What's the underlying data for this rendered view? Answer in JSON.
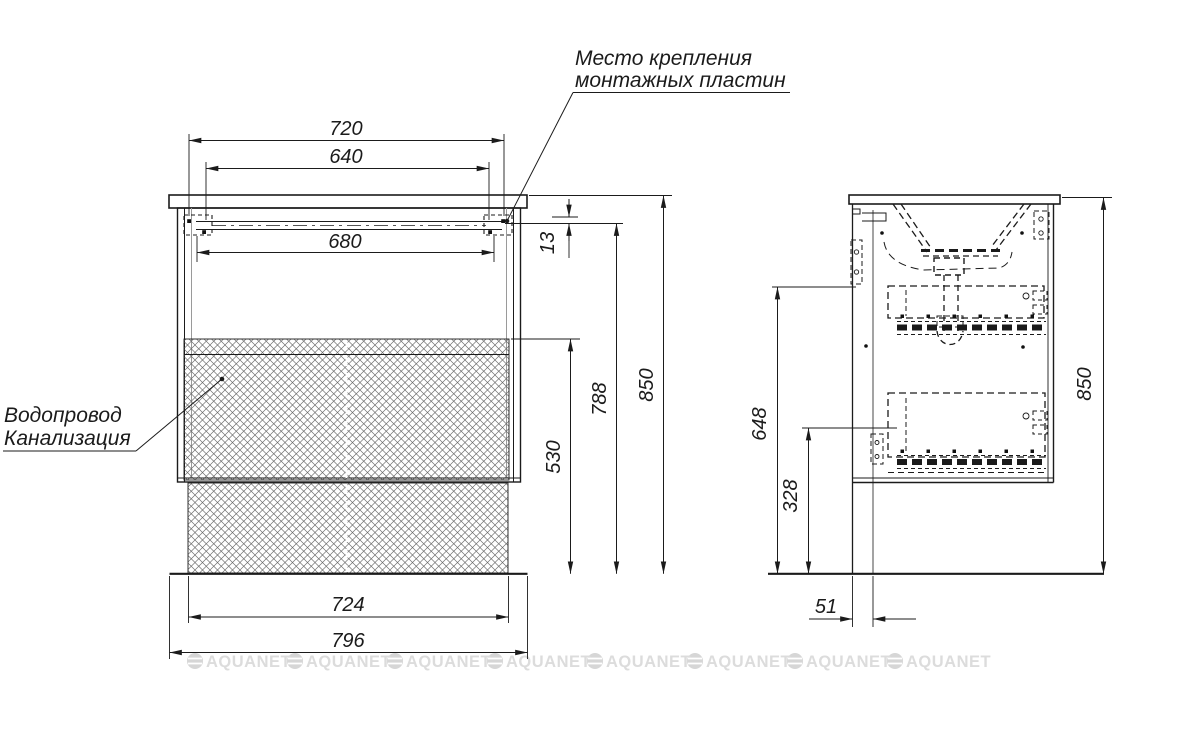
{
  "annotations": {
    "mounting_plates": {
      "line1": "Место крепления",
      "line2": "монтажных пластин"
    },
    "plumbing": {
      "line1": "Водопровод",
      "line2": "Канализация"
    }
  },
  "front_view": {
    "dim_top_outer": "720",
    "dim_top_inner": "640",
    "dim_rail": "680",
    "dim_top_offset": "13",
    "dim_hatch_height": "530",
    "dim_rail_height": "788",
    "dim_overall_height": "850",
    "dim_bottom_inner": "724",
    "dim_bottom_outer": "796"
  },
  "side_view": {
    "dim_siphon_height": "648",
    "dim_outlet_height": "328",
    "dim_back_gap": "51",
    "dim_overall_height": "850"
  },
  "watermark": {
    "text": "AQUANET"
  }
}
